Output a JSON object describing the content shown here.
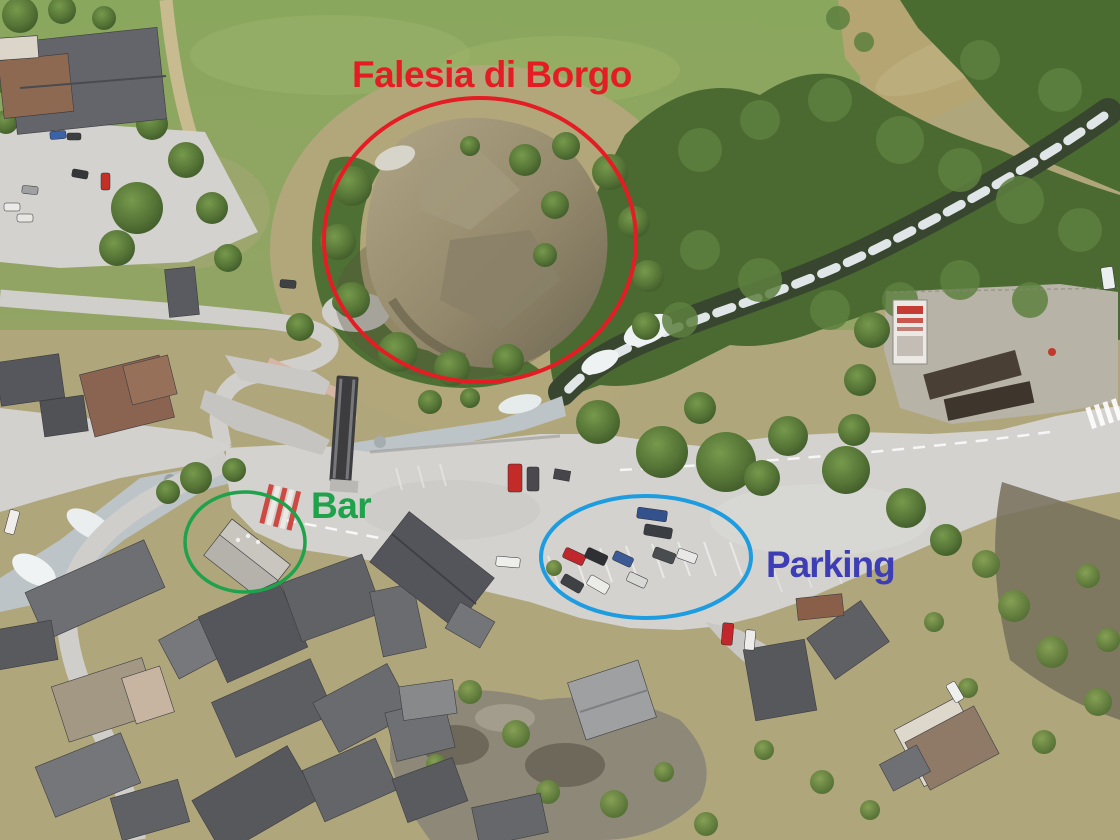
{
  "annotations": {
    "crag": {
      "label": "Falesia di Borgo",
      "color": "#e41d24"
    },
    "bar": {
      "label": "Bar",
      "color": "#1fa24b"
    },
    "parking": {
      "label": "Parking",
      "label_color": "#3d3db5",
      "ellipse_color": "#1d9ce0"
    }
  }
}
